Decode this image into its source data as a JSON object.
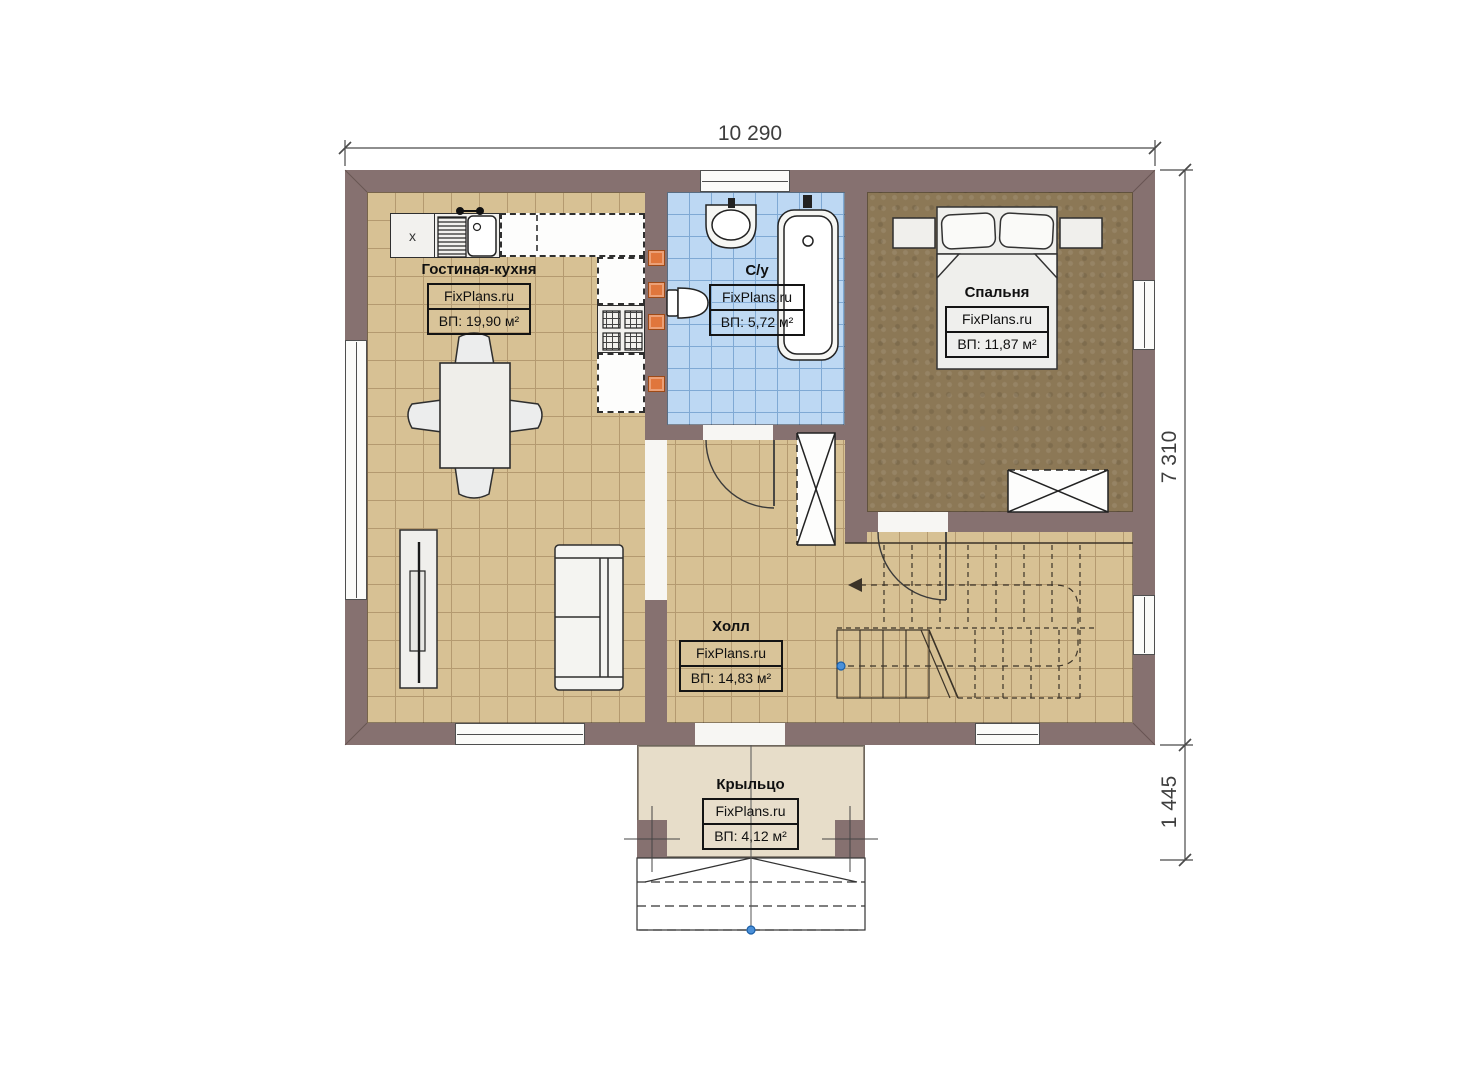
{
  "brand": "FixPlans.ru",
  "dimensions": {
    "top_width": "10 290",
    "right_height": "7 310",
    "porch_height": "1 445"
  },
  "rooms": {
    "living": {
      "name": "Гостиная-кухня",
      "area": "ВП: 19,90 м²"
    },
    "bathroom": {
      "name": "С/у",
      "area": "ВП: 5,72 м²"
    },
    "bedroom": {
      "name": "Спальня",
      "area": "ВП: 11,87 м²"
    },
    "hall": {
      "name": "Холл",
      "area": "ВП: 14,83 м²"
    },
    "porch": {
      "name": "Крыльцо",
      "area": "ВП: 4,12 м²"
    }
  },
  "kitchen": {
    "fridge_marker": "x"
  },
  "colors": {
    "wall": "#867170",
    "floor_tile": "#d7c194",
    "bathroom_tile": "#bdd8f3",
    "bedroom_floor": "#8c7856",
    "porch_floor": "#e7ddc9",
    "accent_orange": "#e0763c",
    "dimension_text": "#3e3e3e"
  }
}
